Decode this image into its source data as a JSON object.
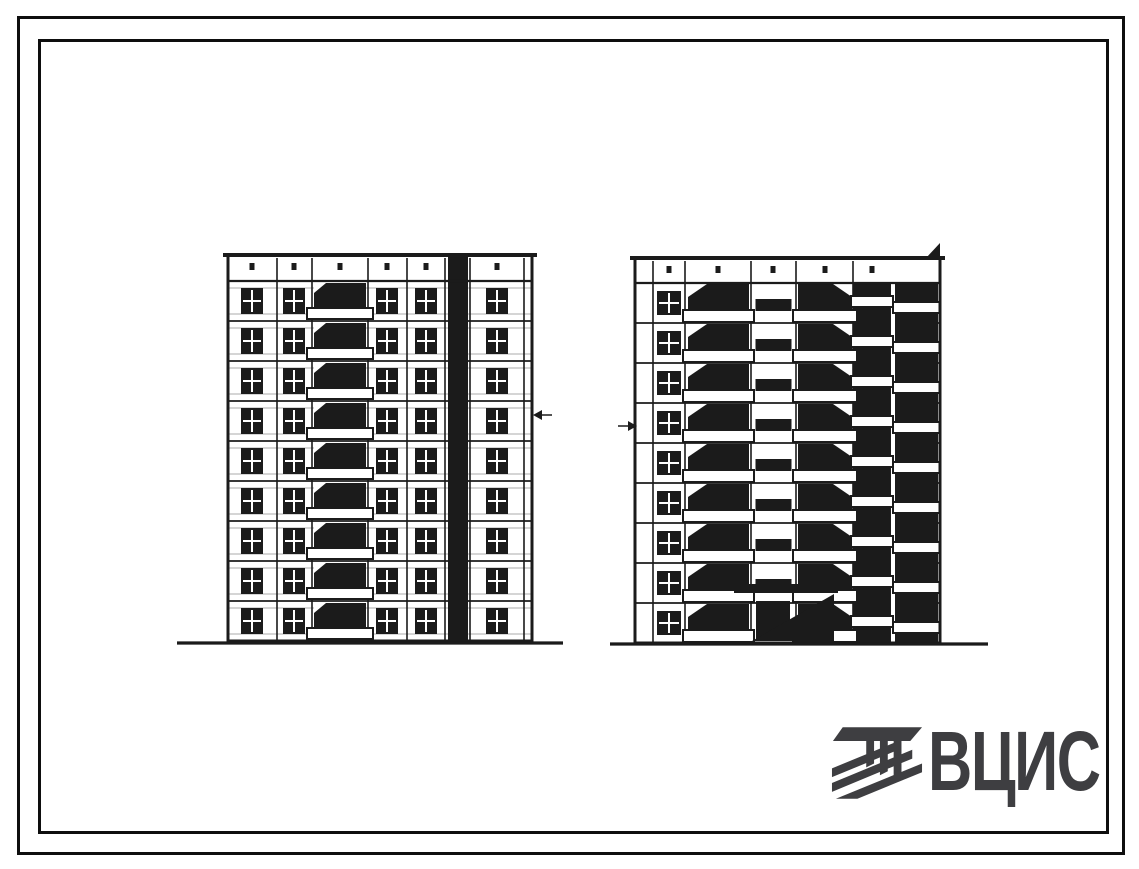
{
  "page": {
    "background": "#ffffff",
    "ink": "#1b1b1b",
    "light_line": "#ababab"
  },
  "logo": {
    "text": "ВЦИС",
    "color": "#3e3e41",
    "icon": "striped-column-emblem"
  },
  "drawing": {
    "type": "architectural-elevation",
    "subject": "two facade elevations of a 9-storey large-panel apartment block",
    "buildings": [
      {
        "id": "front-elevation",
        "floors": 9,
        "left": 228,
        "right": 532,
        "top": 255,
        "parapet_bottom": 281,
        "bottom": 641,
        "verticals": [
          277,
          312,
          368,
          407,
          445,
          470,
          524
        ],
        "window_columns": [
          252,
          294,
          387,
          426,
          497
        ],
        "window": {
          "w": 22,
          "h": 26,
          "dy": 7
        },
        "balcony": {
          "x1": 312,
          "x2": 368,
          "slab_h": 11,
          "overhang": 5
        },
        "shaft": {
          "x1": 448,
          "x2": 468
        },
        "parapet_dots": [
          252,
          294,
          340,
          387,
          426,
          497
        ],
        "ground": {
          "x1": 177,
          "x2": 563,
          "y": 643
        },
        "marker": {
          "x": 533,
          "y": 415,
          "dir": "left"
        }
      },
      {
        "id": "rear-elevation",
        "floors": 9,
        "left": 635,
        "right": 940,
        "top": 258,
        "parapet_bottom": 283,
        "bottom": 643,
        "verticals": [
          653,
          685,
          751,
          796,
          853
        ],
        "window_columns": [
          669
        ],
        "window": {
          "w": 24,
          "h": 24,
          "dy": 8
        },
        "loggias": [
          {
            "x1": 687,
            "x2": 750,
            "style": "open",
            "slab_dy": 27,
            "notch": "left"
          },
          {
            "x1": 797,
            "x2": 853,
            "style": "open",
            "slab_dy": 27,
            "notch": "right"
          },
          {
            "x1": 853,
            "x2": 891,
            "style": "solid",
            "slab_dy": 13
          },
          {
            "x1": 895,
            "x2": 938,
            "style": "solid",
            "slab_dy": 19
          }
        ],
        "stair": {
          "x1": 752,
          "x2": 795,
          "bar_w": 36,
          "bar_h": 12,
          "bar_dy": 16
        },
        "divider": {
          "x": 891,
          "w": 4
        },
        "entrance": {
          "canopy": {
            "x": 734,
            "y": 584,
            "w": 104,
            "h": 9
          },
          "door": {
            "x": 756,
            "y": 601,
            "w": 34,
            "h": 40
          },
          "wedge": [
            [
              752,
              641
            ],
            [
              834,
              594
            ],
            [
              834,
              641
            ]
          ]
        },
        "parapet_dots": [
          669,
          718,
          773,
          825,
          872
        ],
        "corner_flag": [
          [
            926,
            258
          ],
          [
            940,
            243
          ],
          [
            940,
            258
          ]
        ],
        "ground": {
          "x1": 610,
          "x2": 988,
          "y": 644
        },
        "marker": {
          "x": 637,
          "y": 426,
          "dir": "right"
        }
      }
    ]
  }
}
